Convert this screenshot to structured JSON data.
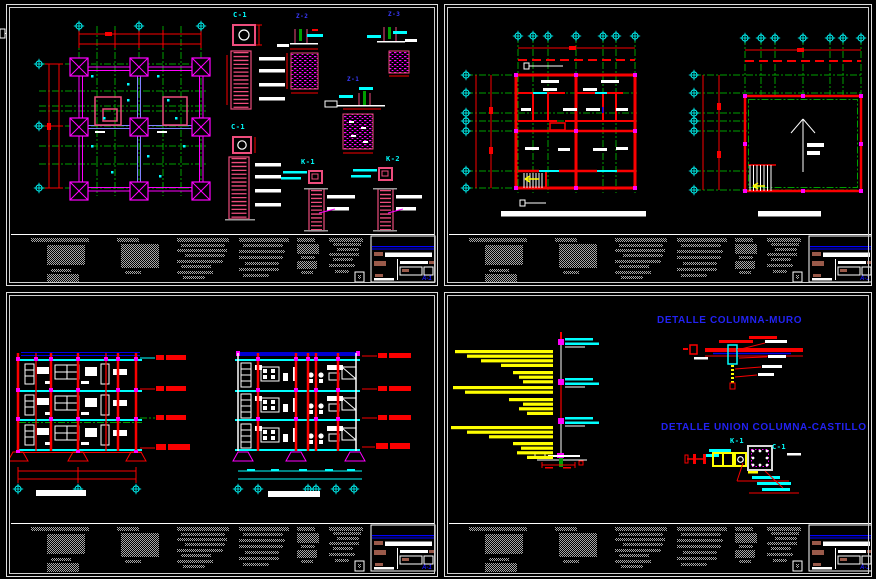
{
  "palette": {
    "background": "#000000",
    "grid_green": "#00a000",
    "dimension_red": "#fa0000",
    "wall_magenta": "#ff00ff",
    "detail_pink": "#ed4d7d",
    "callout_cyan": "#00ffff",
    "annotation_yellow": "#ffff00",
    "title_blue": "#2222f2",
    "notes_gray": "#9a9a9a",
    "titleblock_brown": "#9a5a4a",
    "line_white": "#ffffff"
  },
  "sheet_foundation": {
    "description": "foundation plan with footing and column details",
    "labels": {
      "c1_top": "C-1",
      "c1_mid": "C-1",
      "z2": "Z-2",
      "z3": "Z-3",
      "z1": "Z-1",
      "k1": "K-1",
      "k2": "K-2"
    }
  },
  "sheet_plans": {
    "description": "floor plan and roof plan with grid bubbles and stairs"
  },
  "sheet_sections": {
    "description": "two three-story building sections with level marks"
  },
  "sheet_details": {
    "title_columna_muro": "DETALLE COLUMNA-MURO",
    "title_union": "DETALLE UNION COLUMNA-CASTILLO",
    "labels": {
      "k1": "K-1",
      "c1": "C-1"
    }
  },
  "titleblock": {
    "logo": "A-1"
  }
}
